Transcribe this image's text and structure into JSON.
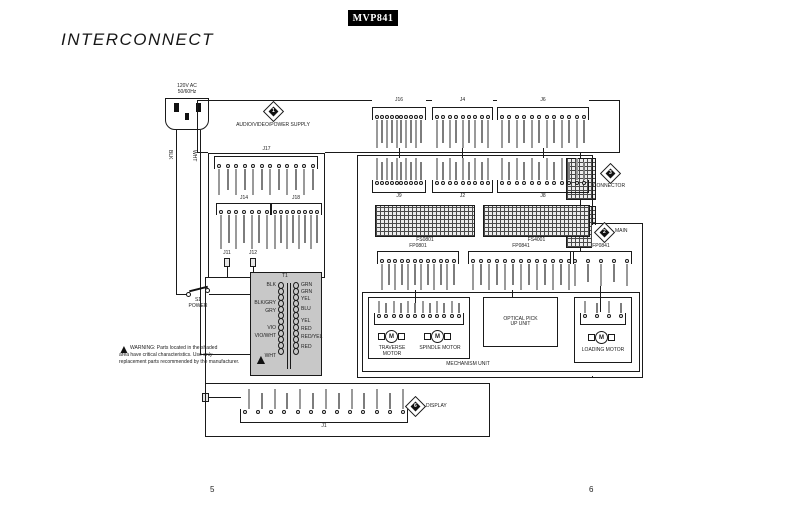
{
  "page": {
    "model_badge": "MVP841",
    "title": "INTERCONNECT",
    "page_number_left": "5",
    "page_number_right": "6"
  },
  "power_input": {
    "rating_line1": "120V AC",
    "rating_line2": "50/60Hz",
    "wire_hot": "BLK",
    "wire_neutral": "WHT",
    "switch_ref": "S1",
    "switch_name": "POWER"
  },
  "boards": {
    "power_supply": {
      "ref_no": "1",
      "name": "AUDIO/VIDEO/POWER SUPPLY"
    },
    "connector": {
      "ref_no": "3",
      "name": "CONNECTOR"
    },
    "main": {
      "ref_no": "2",
      "name": "MAIN"
    },
    "display": {
      "ref_no": "6",
      "name": "DISPLAY"
    }
  },
  "connectors": {
    "ps_top": [
      "J16",
      "J4",
      "J6"
    ],
    "main_top": [
      "J9",
      "J2",
      "J8"
    ],
    "j17": "J17",
    "j14": "J14",
    "j18": "J18",
    "j11": "J11",
    "j12": "J12",
    "ribbon": [
      "FS0801",
      "FS4001"
    ],
    "headers": [
      "FP0801",
      "FP0841",
      "FP0841"
    ],
    "display_header": "J1"
  },
  "transformer": {
    "ref": "T1",
    "primary": [
      "BLK",
      "BLK/GRY",
      "GRY",
      "VIO",
      "VIO/WHT",
      "WHT"
    ],
    "secondary": [
      "GRN",
      "GRN",
      "YEL",
      "BLU",
      "YEL",
      "RED",
      "RED/YEL",
      "RED"
    ]
  },
  "mechanism": {
    "name": "MECHANISM UNIT",
    "optical_unit": "OPTICAL PICK UP UNIT",
    "motor_symbol": "M",
    "traverse_motor": "TRAVERSE MOTOR",
    "spindle_motor": "SPINDLE MOTOR",
    "loading_motor": "LOADING MOTOR"
  },
  "warning": {
    "line1": "WARNING: Parts located in the shaded",
    "line2": "area have critical characteristics. Use only",
    "line3": "replacement parts recommended by the manufacturer."
  },
  "colors": {
    "shaded_area": "#c8c8c8",
    "line": "#1a1a1a",
    "badge_bg": "#000000",
    "badge_text": "#ffffff"
  }
}
